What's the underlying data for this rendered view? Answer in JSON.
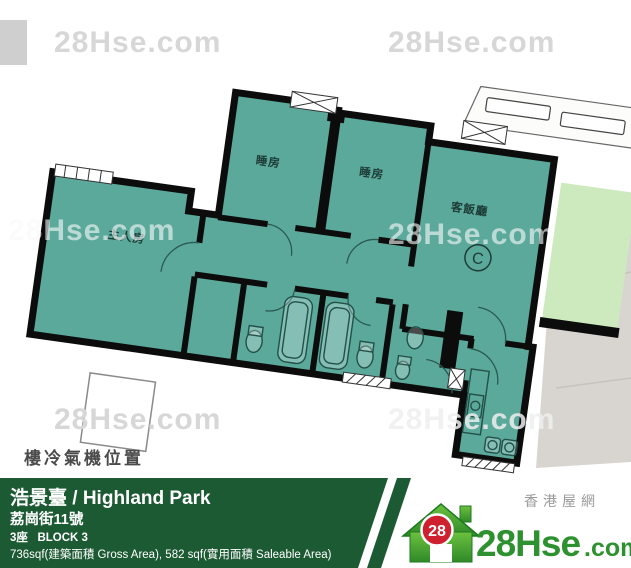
{
  "plan": {
    "note": "樓冷氣機位置",
    "unit_mark": "C",
    "rooms": [
      {
        "label": "睡房"
      },
      {
        "label": "睡房"
      },
      {
        "label": "客飯廳"
      },
      {
        "label": "主人房"
      }
    ]
  },
  "watermark": {
    "text": "28Hse.com"
  },
  "banner": {
    "title": "浩景臺 / Highland Park",
    "address": "荔崗街11號",
    "block": "3座   BLOCK 3",
    "area": "736sqf(建築面積 Gross Area), 582 sqf(實用面積 Saleable Area)"
  },
  "logo": {
    "site_cn": "香港屋網",
    "badge": "28",
    "name": "28Hse",
    "tld": ".com"
  },
  "colors": {
    "plan_teal": "#5ba99b",
    "adjacent_green": "#cdeabe",
    "banner_green": "#1c5a33",
    "brand_green": "#2e9130",
    "badge_red": "#cf2030"
  }
}
